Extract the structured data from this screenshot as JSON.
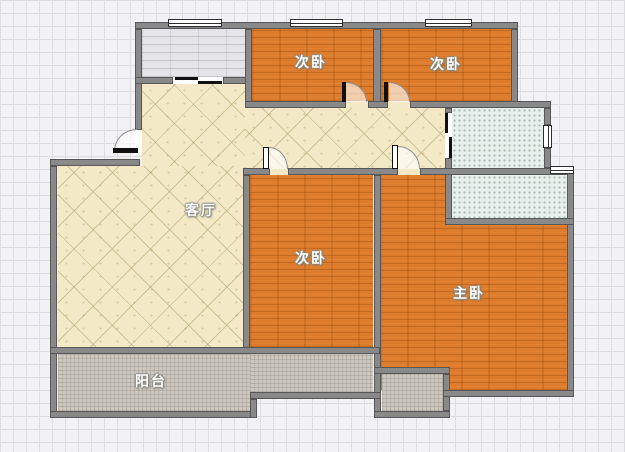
{
  "floorplan": {
    "rooms": [
      {
        "id": "living-room",
        "label": "客厅"
      },
      {
        "id": "bedroom-top-left",
        "label": "次卧"
      },
      {
        "id": "bedroom-top-right",
        "label": "次卧"
      },
      {
        "id": "bedroom-bottom",
        "label": "次卧"
      },
      {
        "id": "master-bedroom",
        "label": "主卧"
      },
      {
        "id": "balcony",
        "label": "阳台"
      },
      {
        "id": "entry-porch",
        "label": ""
      },
      {
        "id": "bath-upper",
        "label": ""
      },
      {
        "id": "bath-lower",
        "label": ""
      },
      {
        "id": "small-balcony",
        "label": ""
      }
    ],
    "colors": {
      "background": "#f2f2f5",
      "grid_line": "#dcdce2",
      "wall": "#898989",
      "wall_edge": "#575757",
      "wood_floor": "#dd7c2c",
      "tile_floor": "#f3e9c7",
      "bath_tile": "#e9efec",
      "balcony_floor": "#ccc8c0",
      "porch_floor": "#e5e5e7",
      "label_text": "#ffffff"
    }
  }
}
